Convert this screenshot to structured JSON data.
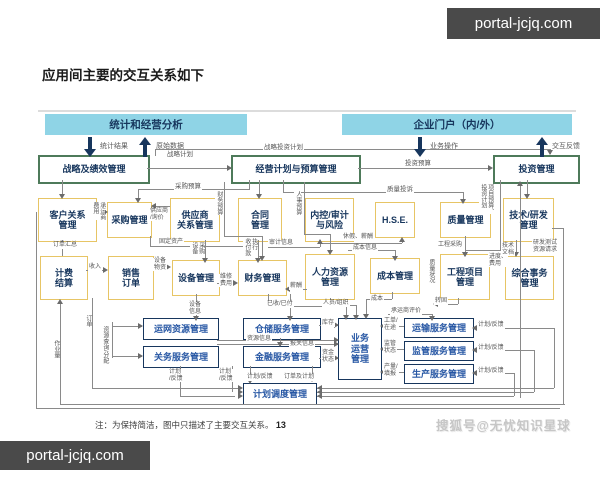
{
  "watermarks": {
    "top_right": "portal-jcjq.com",
    "bottom_left": "portal-jcjq.com",
    "bottom_right": "搜狐号@无忧知识星球"
  },
  "title": "应用间主要的交互关系如下",
  "bars": {
    "stats": "统计和经营分析",
    "portal": "企业门户（内/外）"
  },
  "bar_flows": {
    "stats_down": "统计结果",
    "stats_up": "原始数据",
    "portal_down": "业务操作",
    "portal_up": "交互反馈"
  },
  "boxes": {
    "strategy": "战略及绩效管理",
    "planning": "经营计划与预算管理",
    "investment": "投资管理",
    "crm": "客户关系\n管理",
    "procurement": "采购管理",
    "srm": "供应商\n关系管理",
    "contract": "合同\n管理",
    "audit": "内控/审计\n与风险",
    "hse": "H.S.E.",
    "quality": "质量管理",
    "tech": "技术/研发\n管理",
    "billing": "计费\n结算",
    "sales": "销售\n订单",
    "equipment": "设备管理",
    "finance": "财务管理",
    "hr": "人力资源\n管理",
    "cost": "成本管理",
    "project": "工程项目\n管理",
    "affairs": "综合事务\n管理",
    "network": "运网资源管理",
    "warehouse": "仓储服务管理",
    "customs": "关务服务管理",
    "financial_svc": "金融服务管理",
    "operation": "业务\n运营\n管理",
    "transport": "运输服务管理",
    "supervision": "监管服务管理",
    "production": "生产服务管理",
    "dispatch": "计划调度管理"
  },
  "labels": {
    "strategic_invest_plan": "战略投资计划",
    "strategic_plan": "战略计划",
    "invest_budget": "投资预算",
    "purchase_budget": "采购预算",
    "quality_complaint": "质量投诉",
    "finance_budget": "财务预算",
    "hr_budget": "人事预算",
    "project_budget": "项目预算、\n投资计划",
    "supplier_inquiry": "供应商\n/询价",
    "carrier_fee": "承运商\n费用",
    "order_summary": "订单汇总",
    "fixed_assets": "固定资产",
    "equip_purchase": "设备\n采购",
    "payment_exec": "收付款\n执行",
    "audit_info": "审计信息",
    "leave_salary": "休假、薪酬",
    "cost_info": "成本信息",
    "eng_purchase": "工程采购",
    "tech_doc": "技术\n文档",
    "rd_request": "研发测试\n资源请求",
    "income": "收入",
    "equip_material": "设备\n物资",
    "maintenance_fee": "维修\n费用",
    "salary": "薪酬",
    "paid": "已收/已付",
    "staff_org": "人员/组织",
    "cost_lbl": "成本",
    "carrier_eval": "承运商评价",
    "transfer_fixed": "转固",
    "progress_fee": "进度、\n费用",
    "quality_status": "质量状况",
    "equip_info": "设备\n信息",
    "order_v": "订单",
    "workload": "作业量",
    "resource_query": "资源查询/分配",
    "inventory": "库存",
    "resource_info": "资源信息",
    "customs_info": "报关信息",
    "fund_status": "资金\n状态",
    "work_order": "工单/\n在途",
    "supervise_status": "监管\n状态",
    "output_report": "产量/\n填报",
    "plan_feedback_r1": "计划/反馈",
    "plan_feedback_r2": "计划/反馈",
    "plan_feedback_r3": "计划/反馈",
    "plan_feedback_b1": "计划\n/反馈",
    "plan_feedback_b2": "计划\n/反馈",
    "plan_feedback_b3": "计划/反馈",
    "order_plan": "订单及计划"
  },
  "note": {
    "text": "注：为保持简洁，图中只描述了主要交互关系。",
    "page": "13"
  }
}
